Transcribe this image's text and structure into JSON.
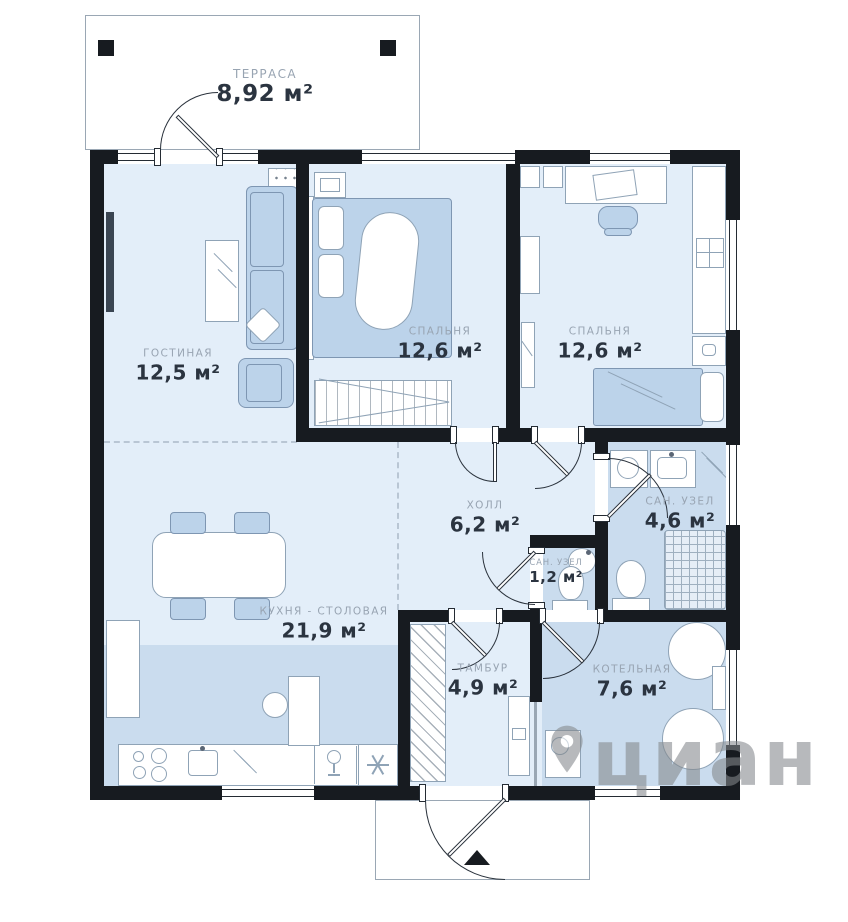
{
  "plan": {
    "title": "floor-plan",
    "rooms": [
      {
        "id": "terrace",
        "name": "ТЕРРАСА",
        "area": "8,92 м²"
      },
      {
        "id": "living-room",
        "name": "ГОСТИНАЯ",
        "area": "12,5 м²"
      },
      {
        "id": "bedroom-1",
        "name": "СПАЛЬНЯ",
        "area": "12,6 м²"
      },
      {
        "id": "bedroom-2",
        "name": "СПАЛЬНЯ",
        "area": "12,6 м²"
      },
      {
        "id": "hall",
        "name": "ХОЛЛ",
        "area": "6,2 м²"
      },
      {
        "id": "bathroom-main",
        "name": "САН. УЗЕЛ",
        "area": "4,6 м²"
      },
      {
        "id": "bathroom-small",
        "name": "САН. УЗЕЛ",
        "area": "1,2 м²"
      },
      {
        "id": "kitchen-dining",
        "name": "КУХНЯ - СТОЛОВАЯ",
        "area": "21,9 м²"
      },
      {
        "id": "vestibule",
        "name": "ТАМБУР",
        "area": "4,9 м²"
      },
      {
        "id": "boiler-room",
        "name": "КОТЕЛЬНАЯ",
        "area": "7,6 м²"
      }
    ],
    "watermark": "циан",
    "colors": {
      "wall": "#171b20",
      "room_light": "#e3eef9",
      "room_wet": "#cadcee",
      "furniture_blue": "#bcd3ea",
      "label_name": "#98a4b2",
      "label_area": "#2b3440",
      "watermark_gray": "#84888c"
    }
  }
}
